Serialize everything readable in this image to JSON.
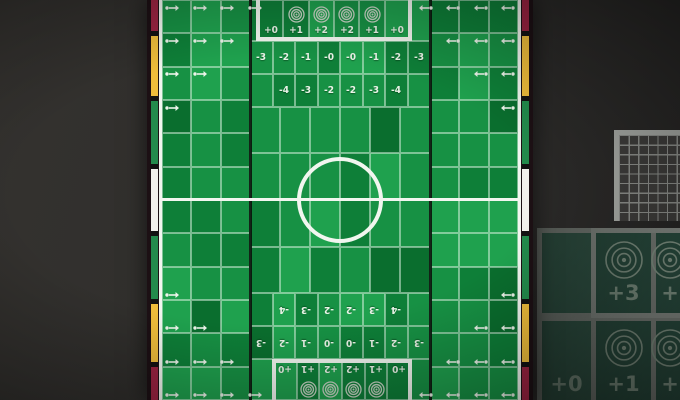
{
  "pitch": {
    "goal_box_top": {
      "labels": [
        "+0",
        "+1",
        "+2",
        "+2",
        "+1",
        "+0"
      ],
      "bullseyes": [
        false,
        true,
        true,
        true,
        true,
        false
      ]
    },
    "modifier_row_top_outer": [
      "-3",
      "-2",
      "-1",
      "-0",
      "-0",
      "-1",
      "-2",
      "-3"
    ],
    "modifier_row_top_inner": [
      "-4",
      "-3",
      "-2",
      "-2",
      "-3",
      "-4"
    ],
    "modifier_row_bottom_inner": [
      "-4",
      "-3",
      "-2",
      "-2",
      "-3",
      "-4"
    ],
    "modifier_row_bottom_outer": [
      "-3",
      "-2",
      "-1",
      "-0",
      "-0",
      "-1",
      "-2",
      "-3"
    ],
    "goal_box_bottom": {
      "labels": [
        "+0",
        "+1",
        "+2",
        "+2",
        "+1",
        "+0"
      ],
      "bullseyes": [
        false,
        true,
        true,
        true,
        true,
        false
      ]
    },
    "throw_in_arrows_per_row": [
      4,
      3,
      2,
      1
    ]
  },
  "side_card": {
    "rows": [
      [
        {
          "label": "",
          "bullseye": false
        },
        {
          "label": "+3",
          "bullseye": true
        },
        {
          "label": "+",
          "bullseye": true
        }
      ],
      [
        {
          "label": "+0",
          "bullseye": false
        },
        {
          "label": "+1",
          "bullseye": true
        },
        {
          "label": "+",
          "bullseye": true
        }
      ]
    ]
  },
  "score_grid": {
    "visible_cols": 7,
    "visible_rows": 9
  },
  "icons": {
    "throw_in": "throw-in-arrow-icon",
    "target": "bullseye-icon"
  },
  "colors": {
    "grass_light": "#1FA14E",
    "grass_mid": "#179144",
    "grass_dark": "#0E7F38",
    "grass_darker": "#0A6E2E",
    "line_white": "#F1F6EF",
    "track_red": "#9C2442",
    "track_yellow": "#EFBD3B",
    "track_green": "#238A4C",
    "track_white": "#F2F1EC",
    "card_green": "#31594A",
    "panel_border": "#9BA09A"
  }
}
